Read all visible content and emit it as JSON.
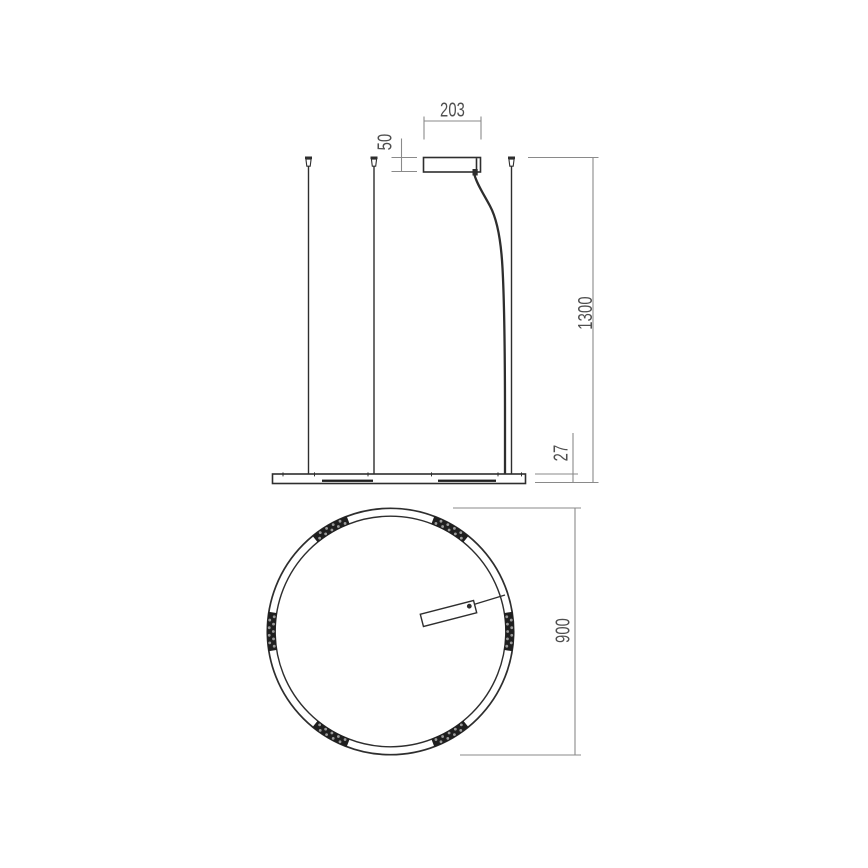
{
  "drawing": {
    "kind": "technical-dimension-drawing",
    "views": {
      "side_elevation": "pendant side view with canopy, suspension wires, power cord and ring profile",
      "plan": "ring plan view with LED clusters and info tag"
    }
  },
  "dims": {
    "canopy_width": {
      "label": "203"
    },
    "canopy_height": {
      "label": "50"
    },
    "drop": {
      "label": "1300"
    },
    "profile_height": {
      "label": "27"
    },
    "ring_diameter": {
      "label": "900"
    }
  },
  "plan": {
    "led_cluster_angles_deg": [
      0,
      60,
      120,
      180,
      240,
      300
    ],
    "led_cluster_half_angle_deg": 9.2
  },
  "colors": {
    "object_line": "#2e2e2e",
    "dim_line": "#8a8a8a",
    "dim_text": "#4f4f4f",
    "led_band": "#1f1f1f",
    "led_dot": "#9b9b9b",
    "background": "#ffffff"
  }
}
